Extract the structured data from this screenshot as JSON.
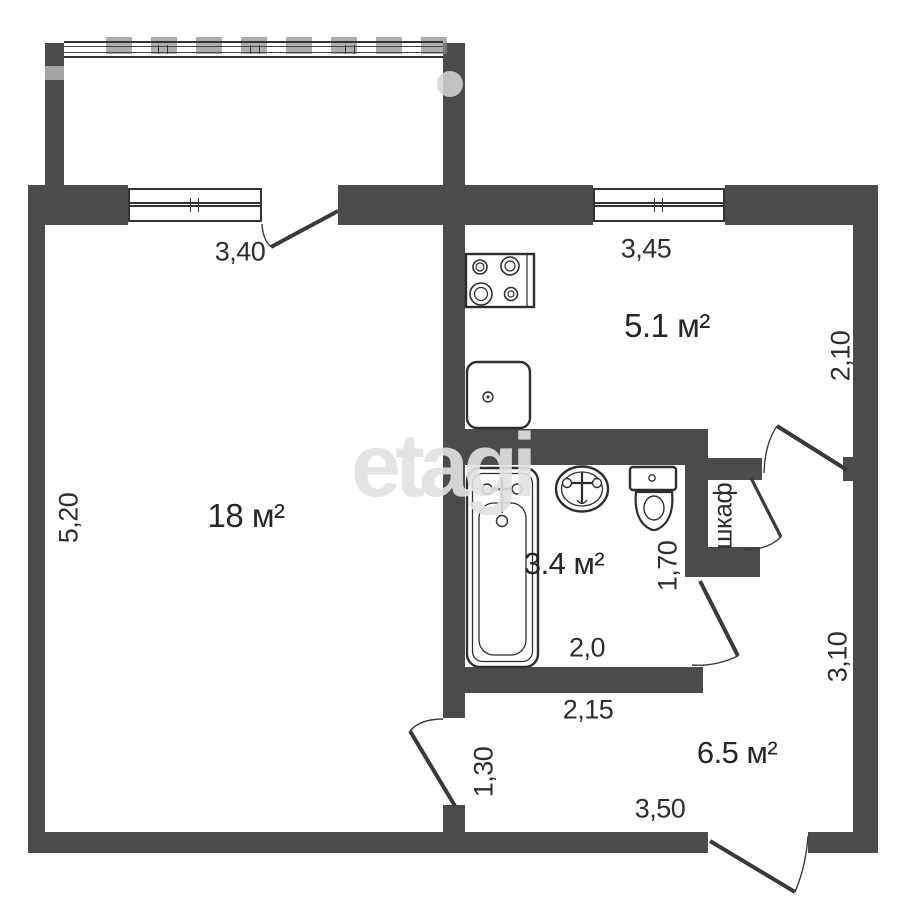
{
  "watermark": {
    "text": "etagi"
  },
  "plan": {
    "title": "one-room apartment floor plan",
    "rooms": [
      {
        "id": "living-room",
        "area_label": "18 м²"
      },
      {
        "id": "kitchen",
        "area_label": "5.1 м²"
      },
      {
        "id": "bathroom",
        "area_label": "3.4 м²"
      },
      {
        "id": "hallway",
        "area_label": "6.5 м²"
      },
      {
        "id": "closet",
        "name_label": "шкаф"
      }
    ],
    "dimensions": {
      "living_top": "3,40",
      "kitchen_top": "3,45",
      "kitchen_right": "2,10",
      "living_left": "5,20",
      "bathroom_right": "1,70",
      "bathroom_bottom": "2,0",
      "hallway_top": "2,15",
      "living_door": "1,30",
      "hallway_right": "3,10",
      "hallway_bottom": "3,50"
    },
    "fixtures": [
      "stove",
      "kitchen-sink",
      "bathtub",
      "washbasin",
      "toilet"
    ],
    "colors": {
      "wall": "#4b4b4b",
      "line": "#2f2f2f",
      "watermark": "#e2e2e2"
    }
  }
}
